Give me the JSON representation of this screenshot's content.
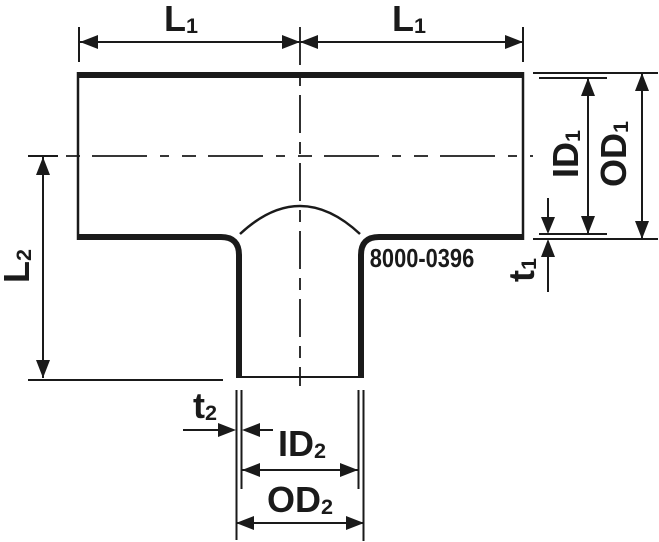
{
  "diagram": {
    "title": "Tee reducing fitting technical drawing",
    "part_number": "8000-0396",
    "colors": {
      "ink": "#1a1a1a",
      "background": "#ffffff"
    },
    "labels": {
      "l1_left": {
        "main": "L",
        "sub": "1"
      },
      "l1_right": {
        "main": "L",
        "sub": "1"
      },
      "l2": {
        "main": "L",
        "sub": "2"
      },
      "id1": {
        "main": "ID",
        "sub": "1"
      },
      "od1": {
        "main": "OD",
        "sub": "1"
      },
      "t1": {
        "main": "t",
        "sub": "1"
      },
      "t2": {
        "main": "t",
        "sub": "2"
      },
      "id2": {
        "main": "ID",
        "sub": "2"
      },
      "od2": {
        "main": "OD",
        "sub": "2"
      }
    }
  }
}
